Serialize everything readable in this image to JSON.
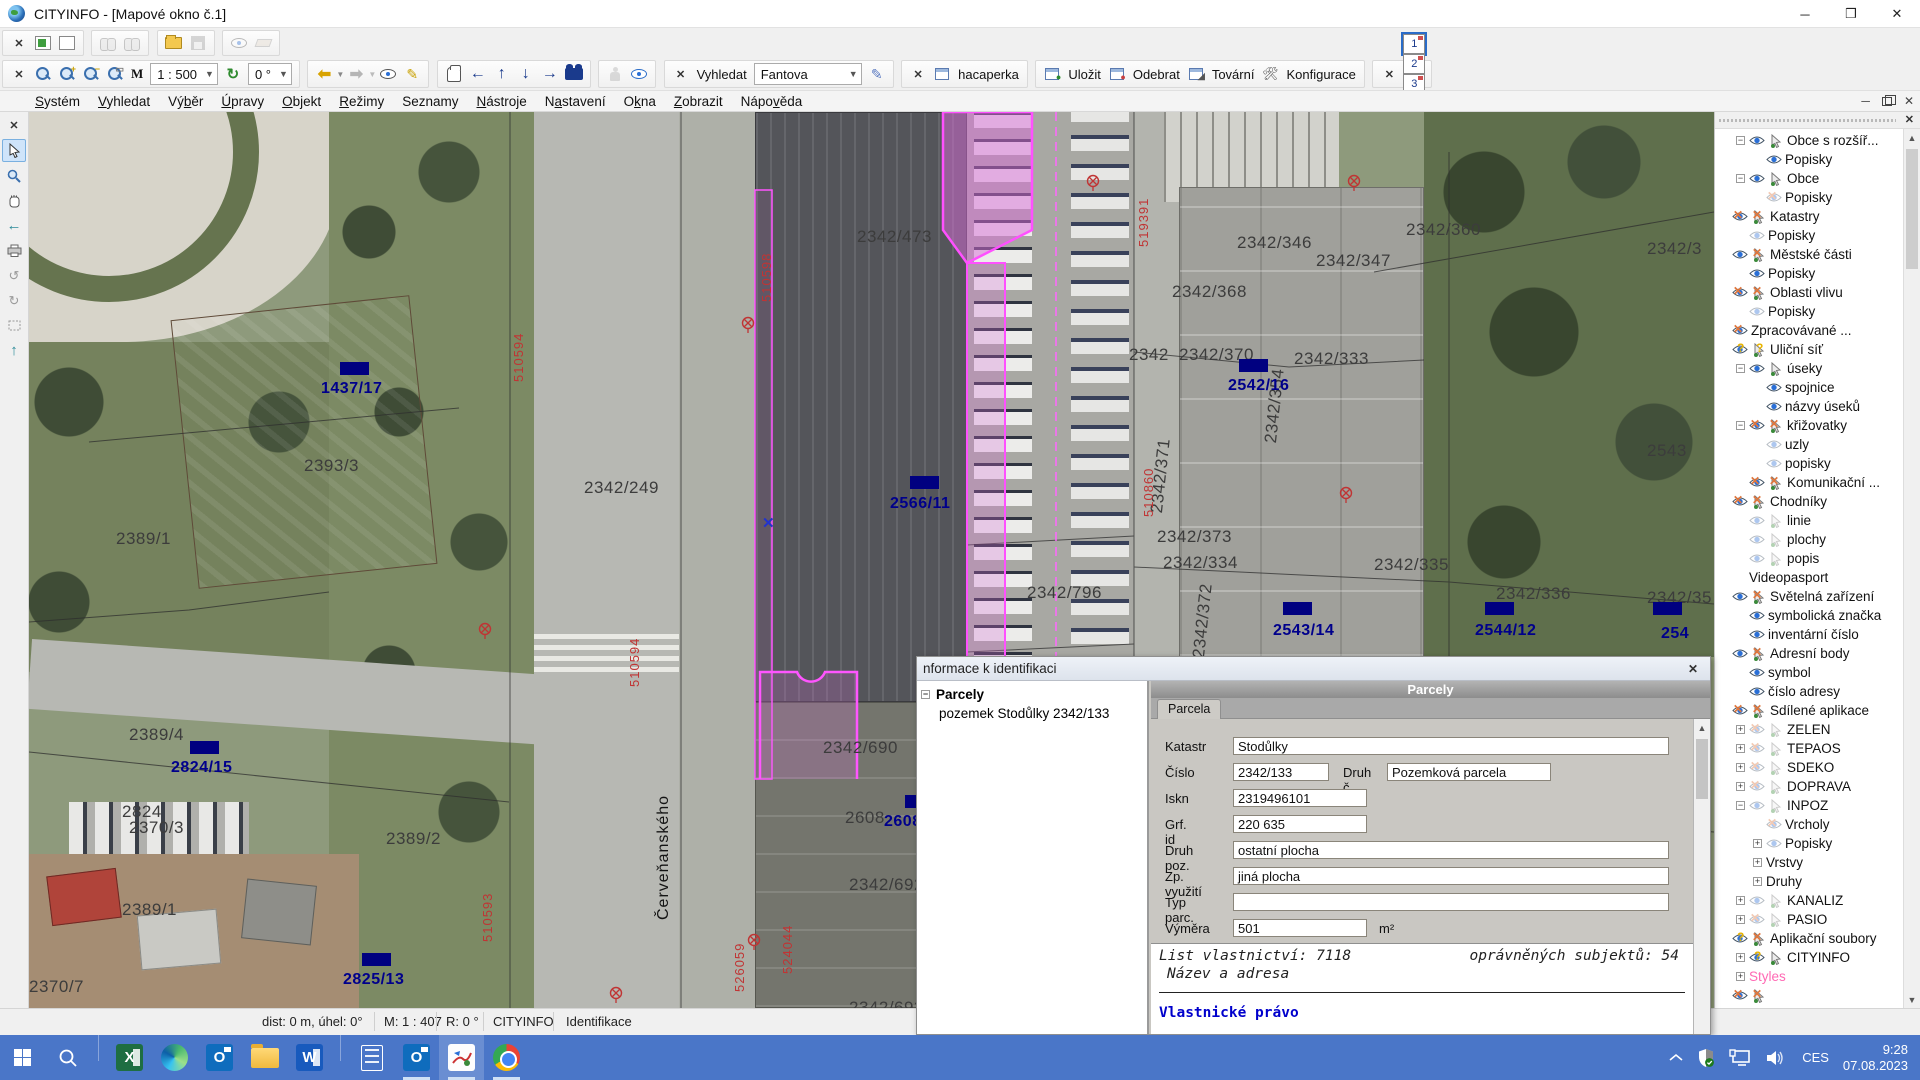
{
  "window": {
    "title": "CITYINFO - [Mapové okno č.1]"
  },
  "toolbar": {
    "scale_prefix": "M",
    "scale_value": "1 : 500",
    "rotation_value": "0 °",
    "search_label": "Vyhledat",
    "search_value": "Fantova",
    "user_button": "hacaperka",
    "save_label": "Uložit",
    "remove_label": "Odebrat",
    "factory_label": "Tovární",
    "config_label": "Konfigurace",
    "window_buttons": [
      "1",
      "2",
      "3",
      "4"
    ]
  },
  "menu": {
    "items": [
      {
        "label": "Systém",
        "accel": 0
      },
      {
        "label": "Vyhledat",
        "accel": 0
      },
      {
        "label": "Výběr",
        "accel": 2
      },
      {
        "label": "Úpravy",
        "accel": 0
      },
      {
        "label": "Objekt",
        "accel": 0
      },
      {
        "label": "Režimy",
        "accel": 0
      },
      {
        "label": "Seznamy",
        "accel": -1
      },
      {
        "label": "Nástroje",
        "accel": 0
      },
      {
        "label": "Nastavení",
        "accel": 1
      },
      {
        "label": "Okna",
        "accel": 1
      },
      {
        "label": "Zobrazit",
        "accel": 0
      },
      {
        "label": "Nápověda",
        "accel": 4
      }
    ]
  },
  "left_toolbar": [
    "close",
    "pointer",
    "magnifier",
    "hand",
    "arrow-left",
    "printer",
    "rotate-a",
    "rotate-b",
    "zoom-rect",
    "arrow-up"
  ],
  "map": {
    "street_name": "Červeňanského",
    "parcel_labels": [
      {
        "t": "2342/473",
        "x": 828,
        "y": 115
      },
      {
        "t": "2342/346",
        "x": 1208,
        "y": 121
      },
      {
        "t": "2342/347",
        "x": 1287,
        "y": 139
      },
      {
        "t": "2342/360",
        "x": 1377,
        "y": 108
      },
      {
        "t": "2342/3",
        "x": 1618,
        "y": 127
      },
      {
        "t": "2342/368",
        "x": 1143,
        "y": 170
      },
      {
        "t": "2342",
        "x": 1100,
        "y": 233
      },
      {
        "t": "2342/370",
        "x": 1150,
        "y": 233
      },
      {
        "t": "2342/333",
        "x": 1265,
        "y": 237
      },
      {
        "t": "2342/249",
        "x": 555,
        "y": 366
      },
      {
        "t": "2342/373",
        "x": 1128,
        "y": 415
      },
      {
        "t": "2342/334",
        "x": 1134,
        "y": 441
      },
      {
        "t": "2342/335",
        "x": 1345,
        "y": 443
      },
      {
        "t": "2342/336",
        "x": 1467,
        "y": 472
      },
      {
        "t": "2342/35",
        "x": 1618,
        "y": 476
      },
      {
        "t": "2543",
        "x": 1618,
        "y": 329
      },
      {
        "t": "2389/1",
        "x": 87,
        "y": 417
      },
      {
        "t": "2393/3",
        "x": 275,
        "y": 344
      },
      {
        "t": "2389/4",
        "x": 100,
        "y": 613
      },
      {
        "t": "2389/2",
        "x": 357,
        "y": 717
      },
      {
        "t": "2824",
        "x": 93,
        "y": 690
      },
      {
        "t": "2370/3",
        "x": 100,
        "y": 706
      },
      {
        "t": "2389/1",
        "x": 93,
        "y": 788
      },
      {
        "t": "2370/7",
        "x": 0,
        "y": 865
      },
      {
        "t": "2342/690",
        "x": 794,
        "y": 626
      },
      {
        "t": "2608",
        "x": 816,
        "y": 696
      },
      {
        "t": "2342/692",
        "x": 820,
        "y": 763
      },
      {
        "t": "2342/693",
        "x": 820,
        "y": 886
      },
      {
        "t": "2342/796",
        "x": 998,
        "y": 471
      }
    ],
    "rotated_parcel_labels": [
      {
        "t": "2342/354",
        "x": 1232,
        "y": 330
      },
      {
        "t": "2342/371",
        "x": 1118,
        "y": 400
      },
      {
        "t": "2342/372",
        "x": 1160,
        "y": 545
      }
    ],
    "blue_labels": [
      {
        "t": "1437/17",
        "x": 292,
        "y": 268,
        "rx": 311,
        "ry": 250
      },
      {
        "t": "2824/15",
        "x": 142,
        "y": 647,
        "rx": 161,
        "ry": 629
      },
      {
        "t": "2825/13",
        "x": 314,
        "y": 859,
        "rx": 333,
        "ry": 841
      },
      {
        "t": "2566/11",
        "x": 861,
        "y": 383,
        "rx": 881,
        "ry": 364
      },
      {
        "t": "2542/16",
        "x": 1199,
        "y": 265,
        "rx": 1210,
        "ry": 247
      },
      {
        "t": "2543/14",
        "x": 1244,
        "y": 510,
        "rx": 1254,
        "ry": 490
      },
      {
        "t": "2544/12",
        "x": 1446,
        "y": 510,
        "rx": 1456,
        "ry": 490
      },
      {
        "t": "254",
        "x": 1632,
        "y": 513,
        "rx": 1624,
        "ry": 490
      },
      {
        "t": "2608",
        "x": 855,
        "y": 701,
        "rx": 876,
        "ry": 683
      }
    ],
    "red_labels": [
      {
        "t": "510594",
        "x": 482,
        "y": 270
      },
      {
        "t": "510594",
        "x": 598,
        "y": 575
      },
      {
        "t": "510593",
        "x": 451,
        "y": 830
      },
      {
        "t": "519391",
        "x": 1107,
        "y": 135
      },
      {
        "t": "510860",
        "x": 1112,
        "y": 405
      },
      {
        "t": "510598",
        "x": 730,
        "y": 190
      },
      {
        "t": "524044",
        "x": 751,
        "y": 862
      },
      {
        "t": "526059",
        "x": 703,
        "y": 880
      }
    ],
    "red_markers": [
      [
        449,
        510
      ],
      [
        712,
        204
      ],
      [
        580,
        874
      ],
      [
        718,
        821
      ],
      [
        1057,
        62
      ],
      [
        1318,
        62
      ],
      [
        1310,
        374
      ]
    ],
    "blue_cross": {
      "x": 733,
      "y": 402
    }
  },
  "layer_panel": {
    "items": [
      {
        "label": "Obce s rozšíř...",
        "lvl": 1,
        "exp": "-",
        "icons": [
          "eye",
          "cur"
        ]
      },
      {
        "label": "Popisky",
        "lvl": 2,
        "exp": "",
        "icons": [
          "eye"
        ]
      },
      {
        "label": "Obce",
        "lvl": 1,
        "exp": "-",
        "icons": [
          "eye",
          "cur"
        ]
      },
      {
        "label": "Popisky",
        "lvl": 2,
        "exp": "",
        "icons": [
          "eyexd"
        ]
      },
      {
        "label": "Katastry",
        "lvl": 0,
        "exp": "",
        "icons": [
          "eyex",
          "curx"
        ]
      },
      {
        "label": "Popisky",
        "lvl": 1,
        "exp": "",
        "icons": [
          "eyed"
        ]
      },
      {
        "label": "Městské části",
        "lvl": 0,
        "exp": "",
        "icons": [
          "eye",
          "curx"
        ]
      },
      {
        "label": "Popisky",
        "lvl": 1,
        "exp": "",
        "icons": [
          "eye"
        ]
      },
      {
        "label": "Oblasti vlivu",
        "lvl": 0,
        "exp": "",
        "icons": [
          "eyex",
          "curx"
        ]
      },
      {
        "label": "Popisky",
        "lvl": 1,
        "exp": "",
        "icons": [
          "eyed"
        ]
      },
      {
        "label": "Zpracovávané ...",
        "lvl": 0,
        "exp": "",
        "icons": [
          "eyex"
        ]
      },
      {
        "label": "Uliční síť",
        "lvl": 0,
        "exp": "",
        "icons": [
          "eyeq",
          "curq"
        ]
      },
      {
        "label": "úseky",
        "lvl": 1,
        "exp": "-",
        "icons": [
          "eye",
          "cur"
        ]
      },
      {
        "label": "spojnice",
        "lvl": 2,
        "exp": "",
        "icons": [
          "eye"
        ]
      },
      {
        "label": "názvy úseků",
        "lvl": 2,
        "exp": "",
        "icons": [
          "eye"
        ]
      },
      {
        "label": "křižovatky",
        "lvl": 1,
        "exp": "-",
        "icons": [
          "eyex",
          "curx"
        ]
      },
      {
        "label": "uzly",
        "lvl": 2,
        "exp": "",
        "icons": [
          "eyed"
        ]
      },
      {
        "label": "popisky",
        "lvl": 2,
        "exp": "",
        "icons": [
          "eyed"
        ]
      },
      {
        "label": "Komunikační ...",
        "lvl": 1,
        "exp": "",
        "icons": [
          "eyex",
          "curx"
        ]
      },
      {
        "label": "Chodníky",
        "lvl": 0,
        "exp": "",
        "icons": [
          "eyex",
          "curx"
        ]
      },
      {
        "label": "linie",
        "lvl": 1,
        "exp": "",
        "icons": [
          "eyed",
          "curd"
        ]
      },
      {
        "label": "plochy",
        "lvl": 1,
        "exp": "",
        "icons": [
          "eyed",
          "curd"
        ]
      },
      {
        "label": "popis",
        "lvl": 1,
        "exp": "",
        "icons": [
          "eyed",
          "curd"
        ]
      },
      {
        "label": "Videopasport",
        "lvl": 1,
        "exp": "",
        "icons": []
      },
      {
        "label": "Světelná zařízení",
        "lvl": 0,
        "exp": "",
        "icons": [
          "eye",
          "curx"
        ]
      },
      {
        "label": "symbolická značka",
        "lvl": 1,
        "exp": "",
        "icons": [
          "eye"
        ]
      },
      {
        "label": "inventární číslo",
        "lvl": 1,
        "exp": "",
        "icons": [
          "eye"
        ]
      },
      {
        "label": "Adresní body",
        "lvl": 0,
        "exp": "",
        "icons": [
          "eye",
          "curx"
        ]
      },
      {
        "label": "symbol",
        "lvl": 1,
        "exp": "",
        "icons": [
          "eye"
        ]
      },
      {
        "label": "číslo adresy",
        "lvl": 1,
        "exp": "",
        "icons": [
          "eye"
        ]
      },
      {
        "label": "Sdílené aplikace",
        "lvl": 0,
        "exp": "",
        "icons": [
          "eyex",
          "curx"
        ]
      },
      {
        "label": "ZELEN",
        "lvl": 1,
        "exp": "+",
        "icons": [
          "eyexd",
          "curd"
        ]
      },
      {
        "label": "TEPAOS",
        "lvl": 1,
        "exp": "+",
        "icons": [
          "eyexd",
          "curd"
        ]
      },
      {
        "label": "SDEKO",
        "lvl": 1,
        "exp": "+",
        "icons": [
          "eyexd",
          "curd"
        ]
      },
      {
        "label": "DOPRAVA",
        "lvl": 1,
        "exp": "+",
        "icons": [
          "eyexd",
          "curd"
        ]
      },
      {
        "label": "INPOZ",
        "lvl": 1,
        "exp": "-",
        "icons": [
          "eyed",
          "curd"
        ]
      },
      {
        "label": "Vrcholy",
        "lvl": 2,
        "exp": "",
        "icons": [
          "eyexd"
        ]
      },
      {
        "label": "Popisky",
        "lvl": 2,
        "exp": "+",
        "icons": [
          "eyed"
        ]
      },
      {
        "label": "Vrstvy",
        "lvl": 2,
        "exp": "+",
        "icons": []
      },
      {
        "label": "Druhy",
        "lvl": 2,
        "exp": "+",
        "icons": []
      },
      {
        "label": "KANALIZ",
        "lvl": 1,
        "exp": "+",
        "icons": [
          "eyed",
          "curd"
        ]
      },
      {
        "label": "PASIO",
        "lvl": 1,
        "exp": "+",
        "icons": [
          "eyexd",
          "curd"
        ]
      },
      {
        "label": "Aplikační soubory",
        "lvl": 0,
        "exp": "",
        "icons": [
          "eyeq",
          "curx"
        ]
      },
      {
        "label": "CITYINFO",
        "lvl": 1,
        "exp": "+",
        "icons": [
          "eyeq",
          "cur"
        ]
      },
      {
        "label": "Styles",
        "lvl": 1,
        "exp": "+",
        "icons": [],
        "color": "#ff69b4"
      },
      {
        "label": "",
        "lvl": 0,
        "exp": "",
        "icons": [
          "eyex",
          "curx"
        ]
      }
    ]
  },
  "dialog": {
    "title": "nformace k identifikaci",
    "tree_root": "Parcely",
    "tree_child": "pozemek Stodůlky 2342/133",
    "header": "Parcely",
    "tab": "Parcela",
    "fields": {
      "katastr_label": "Katastr",
      "katastr": "Stodůlky",
      "cislo_label": "Číslo",
      "cislo": "2342/133",
      "druhc_label": "Druh č.",
      "druhc": "Pozemková parcela",
      "iskn_label": "Iskn",
      "iskn": "2319496101",
      "grfid_label": "Grf. id",
      "grfid": "220 635",
      "druhpoz_label": "Druh poz.",
      "druhpoz": "ostatní plocha",
      "zpvyuziti_label": "Zp. využití",
      "zpvyuziti": "jiná plocha",
      "typparc_label": "Typ parc.",
      "typparc": "",
      "vymera_label": "Výměra",
      "vymera": "501",
      "vymera_unit": "m²"
    },
    "text": {
      "line1a": "List vlastnictví: 7118",
      "line1b": "oprávněných subjektů: 54",
      "line2": "Název a adresa",
      "line3": "Vlastnické právo"
    }
  },
  "statusbar": {
    "dist": "dist: 0 m, úhel: 0°",
    "scale": "M: 1 : 407",
    "rotation": "R: 0 °",
    "app": "CITYINFO",
    "mode": "Identifikace"
  },
  "taskbar": {
    "apps": [
      {
        "name": "start",
        "kind": "start"
      },
      {
        "name": "search",
        "kind": "search"
      },
      {
        "name": "sep",
        "kind": "sep"
      },
      {
        "name": "excel",
        "kind": "excel"
      },
      {
        "name": "edge",
        "kind": "edge"
      },
      {
        "name": "outlook",
        "kind": "outlook"
      },
      {
        "name": "file-explorer",
        "kind": "folder"
      },
      {
        "name": "word",
        "kind": "word"
      },
      {
        "name": "sep",
        "kind": "sep"
      },
      {
        "name": "calculator",
        "kind": "calc"
      },
      {
        "name": "outlook-running",
        "kind": "outlook",
        "run": true
      },
      {
        "name": "cityinfo-app",
        "kind": "gis",
        "run": true,
        "active": true
      },
      {
        "name": "chrome",
        "kind": "chrome",
        "run": true
      }
    ],
    "lang": "CES",
    "time": "9:28",
    "date": "07.08.2023"
  }
}
